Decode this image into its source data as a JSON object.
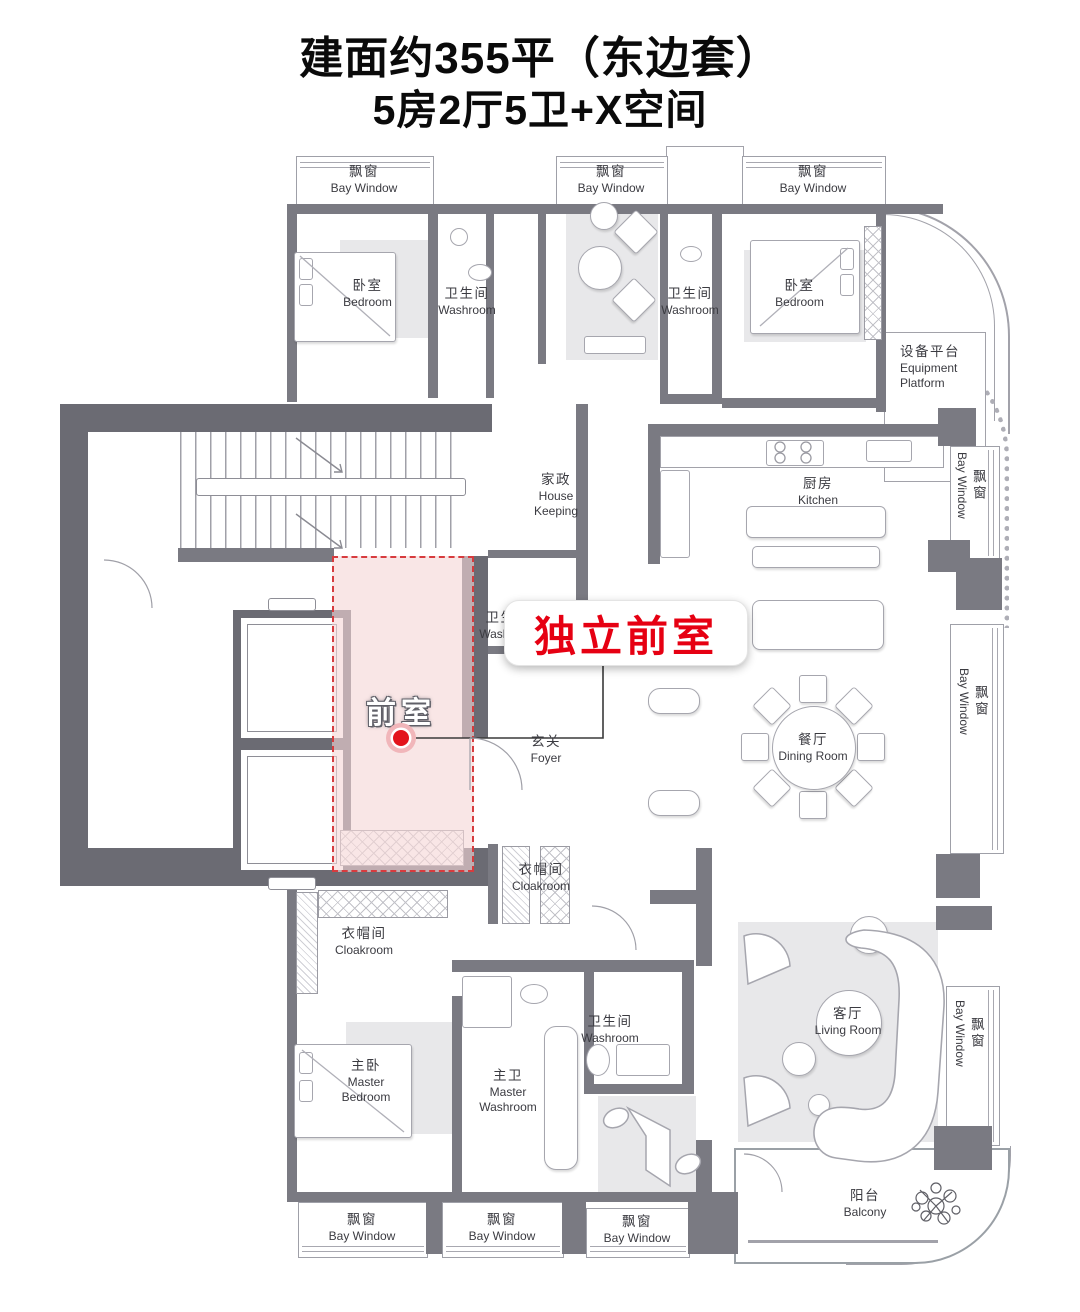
{
  "title": {
    "line1": "建面约355平（东边套）",
    "line2": "5房2厅5卫+X空间"
  },
  "highlight": {
    "room": "前室",
    "callout": "独立前室"
  },
  "labels": {
    "bay": {
      "zh": "飘窗",
      "en": "Bay Window"
    },
    "bedroom": {
      "zh": "卧室",
      "en": "Bedroom"
    },
    "washroom": {
      "zh": "卫生间",
      "en": "Washroom"
    },
    "equipment_platform": {
      "zh": "设备平台",
      "en": "Equipment Platform"
    },
    "house_keeping": {
      "zh": "家政",
      "en": "House Keeping"
    },
    "kitchen": {
      "zh": "厨房",
      "en": "Kitchen"
    },
    "foyer": {
      "zh": "玄关",
      "en": "Foyer"
    },
    "dining_room": {
      "zh": "餐厅",
      "en": "Dining Room"
    },
    "cloakroom": {
      "zh": "衣帽间",
      "en": "Cloakroom"
    },
    "master_bedroom": {
      "zh": "主卧",
      "en": "Master Bedroom"
    },
    "master_washroom": {
      "zh": "主卫",
      "en": "Master Washroom"
    },
    "living_room": {
      "zh": "客厅",
      "en": "Living Room"
    },
    "balcony": {
      "zh": "阳台",
      "en": "Balcony"
    }
  },
  "colors": {
    "wall": "#7a7a82",
    "wall_dark": "#6b6b73",
    "highlight_fill": "#f6d6d6",
    "highlight_border": "#d73b3e",
    "callout_red": "#e60012",
    "marker_red": "#e3141c"
  }
}
